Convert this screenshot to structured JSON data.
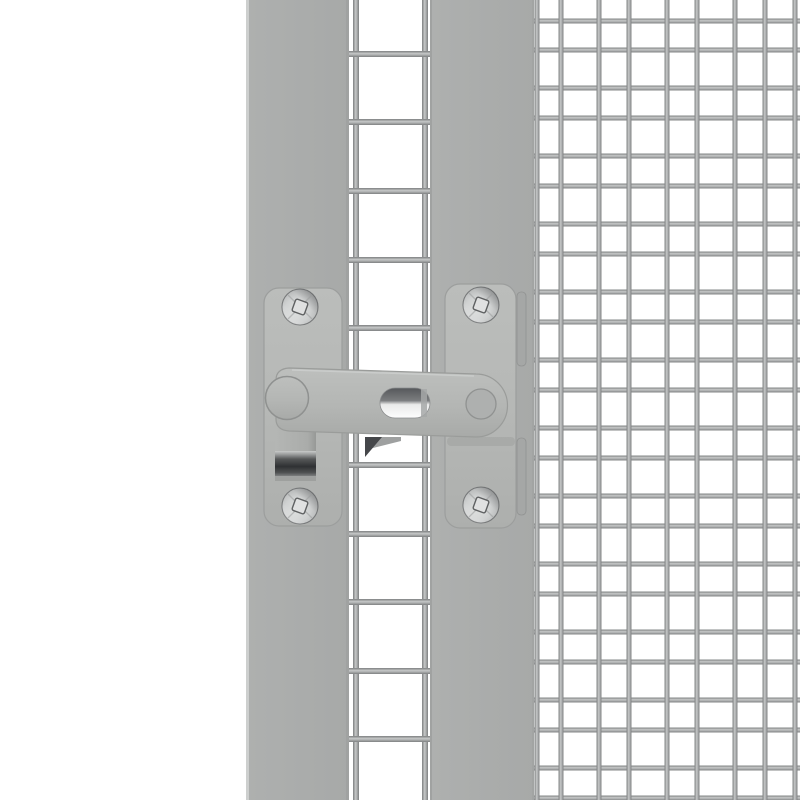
{
  "scene": {
    "title": "Galvanised grey gate latch on wire mesh cage door",
    "alt": "Close-up of a light grey metal bar latch with two mounting plates and four screws, fixed across a grey door post and frame post, with a narrow welded-wire door edge strip between the posts and a large welded wire mesh panel on the right"
  },
  "palette": {
    "background": "#ffffff",
    "post": "#aaacab",
    "post-highlight": "#cdcfce",
    "post-edge": "#a0a2a1",
    "plate": "#b6b8b6",
    "plate-outline": "#9c9e9d",
    "arm": "#b4b6b4",
    "arm-outline": "#9a9c9a",
    "wire": "#a6a8a8",
    "wire-highlight": "#c6c8c8",
    "wire-shadow": "#7e8081",
    "screw": "#cfd1d1",
    "screw-outline": "#767879",
    "hook-shadow": "#2f3133",
    "slot-shadow": "#56585b",
    "cast-shadow": "#45474a"
  },
  "geometry": {
    "canvas": {
      "w": 800,
      "h": 800
    },
    "left_post": {
      "x": 246,
      "w": 103
    },
    "middle_post": {
      "x": 430,
      "w": 104
    },
    "door_strip": {
      "vertical_wire_centers_x": [
        356,
        425
      ],
      "horizontal_wire_centers_y": [
        54,
        122,
        191,
        260,
        328,
        396,
        465,
        534,
        602,
        671,
        739
      ],
      "wire_thickness": 6,
      "span_x0": 348,
      "span_x1": 432
    },
    "cage_mesh": {
      "x0": 534,
      "vertical_wire_centers_x": [
        537,
        561,
        599,
        629,
        667,
        697,
        735,
        765,
        795
      ],
      "horizontal_wire_centers_y": [
        21,
        50,
        88,
        118,
        156,
        186,
        224,
        254,
        292,
        322,
        360,
        390,
        428,
        458,
        496,
        526,
        564,
        594,
        632,
        662,
        700,
        730,
        768,
        798
      ],
      "wire_thickness": 5
    },
    "screws": [
      {
        "cx": 300,
        "cy": 307
      },
      {
        "cx": 300,
        "cy": 506
      },
      {
        "cx": 481,
        "cy": 305
      },
      {
        "cx": 481,
        "cy": 505
      }
    ],
    "screw_radius": 18
  }
}
